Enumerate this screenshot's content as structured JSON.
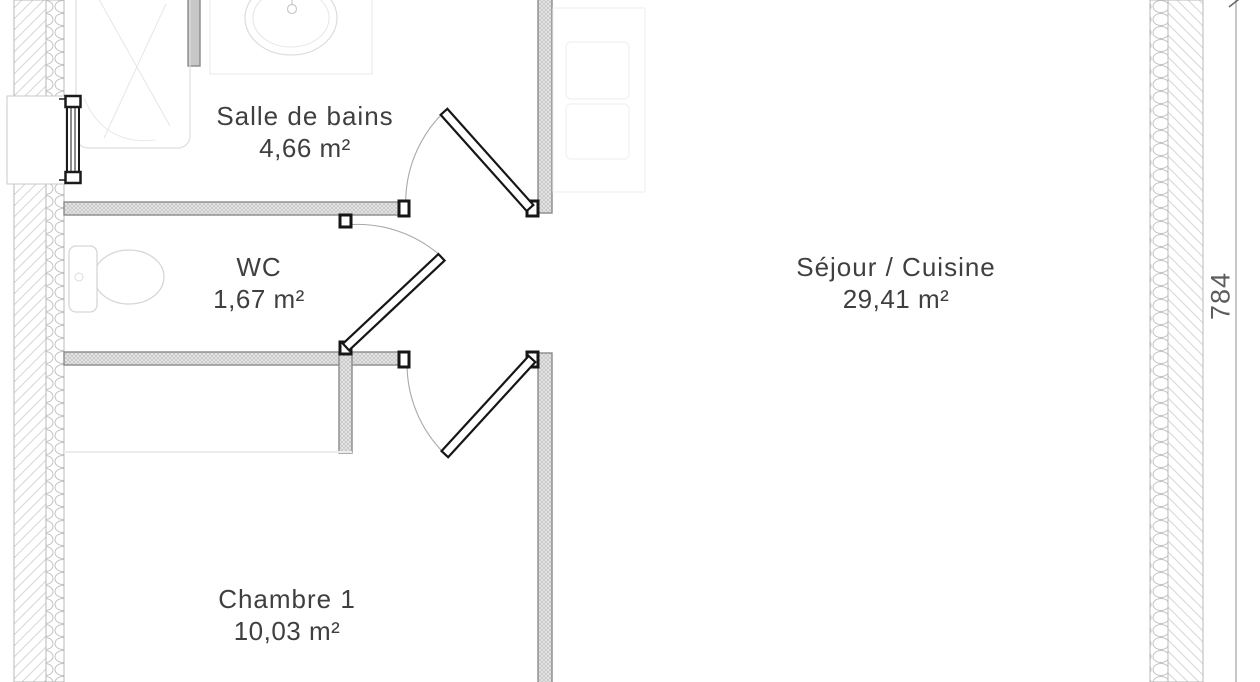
{
  "plan_title": "Floor plan with room areas",
  "rooms": [
    {
      "id": "salle-de-bains",
      "name": "Salle de bains",
      "area": "4,66 m²"
    },
    {
      "id": "wc",
      "name": "WC",
      "area": "1,67 m²"
    },
    {
      "id": "sejour-cuisine",
      "name": "Séjour / Cuisine",
      "area": "29,41 m²"
    },
    {
      "id": "chambre-1",
      "name": "Chambre 1",
      "area": "10,03 m²"
    }
  ],
  "dimension": {
    "value": "784"
  },
  "colors": {
    "text": "#3f3f3f",
    "dimension_text": "#5d5d5d",
    "wall_outline": "#8a8a8a",
    "exterior_hatch": "#d6d6d6",
    "insulation": "#c2c2c2",
    "partition_fill": "#e6e6e6",
    "door": "#161616",
    "swing_arc": "#a8a8a8",
    "fixture": "#d9d9d9"
  }
}
